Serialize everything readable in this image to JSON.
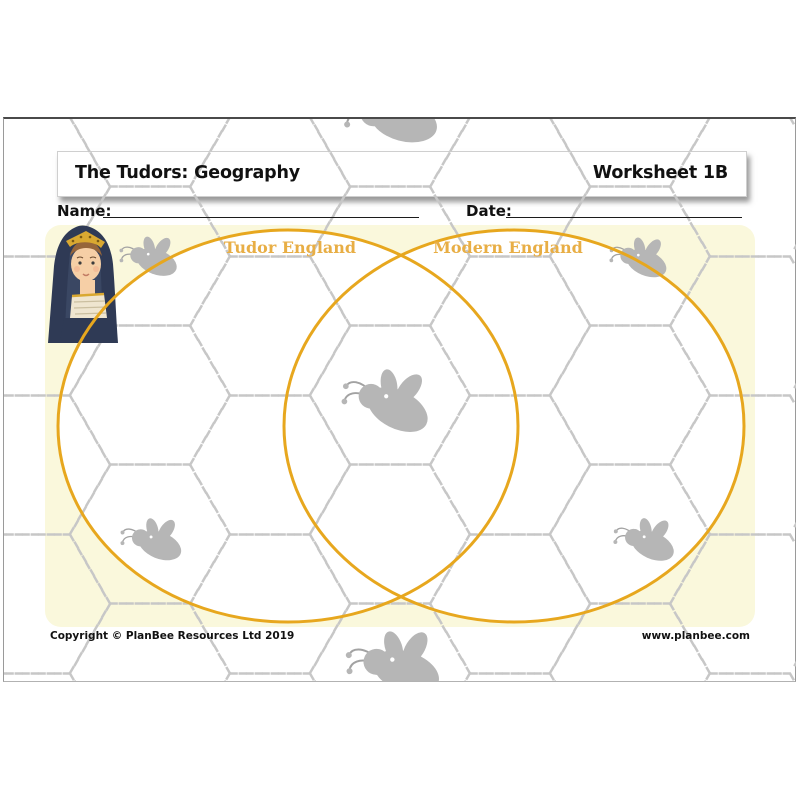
{
  "header": {
    "title": "The Tudors: Geography",
    "worksheet_label": "Worksheet 1B"
  },
  "fields": {
    "name_label": "Name:",
    "date_label": "Date:"
  },
  "venn_diagram": {
    "left_circle_label": "Tudor England",
    "right_circle_label": "Modern England",
    "circle_color": "#E7A71E",
    "label_color": "#E8AE45"
  },
  "footer": {
    "copyright": "Copyright © PlanBee Resources Ltd 2019",
    "website": "www.planbee.com"
  },
  "decorations": {
    "panel_color": "#FAF8DC",
    "hex_pattern_color": "#C7C7C7",
    "bee_color": "#B6B6B6",
    "icons": [
      {
        "name": "tudor-queen-icon",
        "description": "Tudor queen portrait illustration"
      },
      {
        "name": "bee-icon",
        "description": "PlanBee bee silhouette (7 placements)"
      }
    ]
  }
}
